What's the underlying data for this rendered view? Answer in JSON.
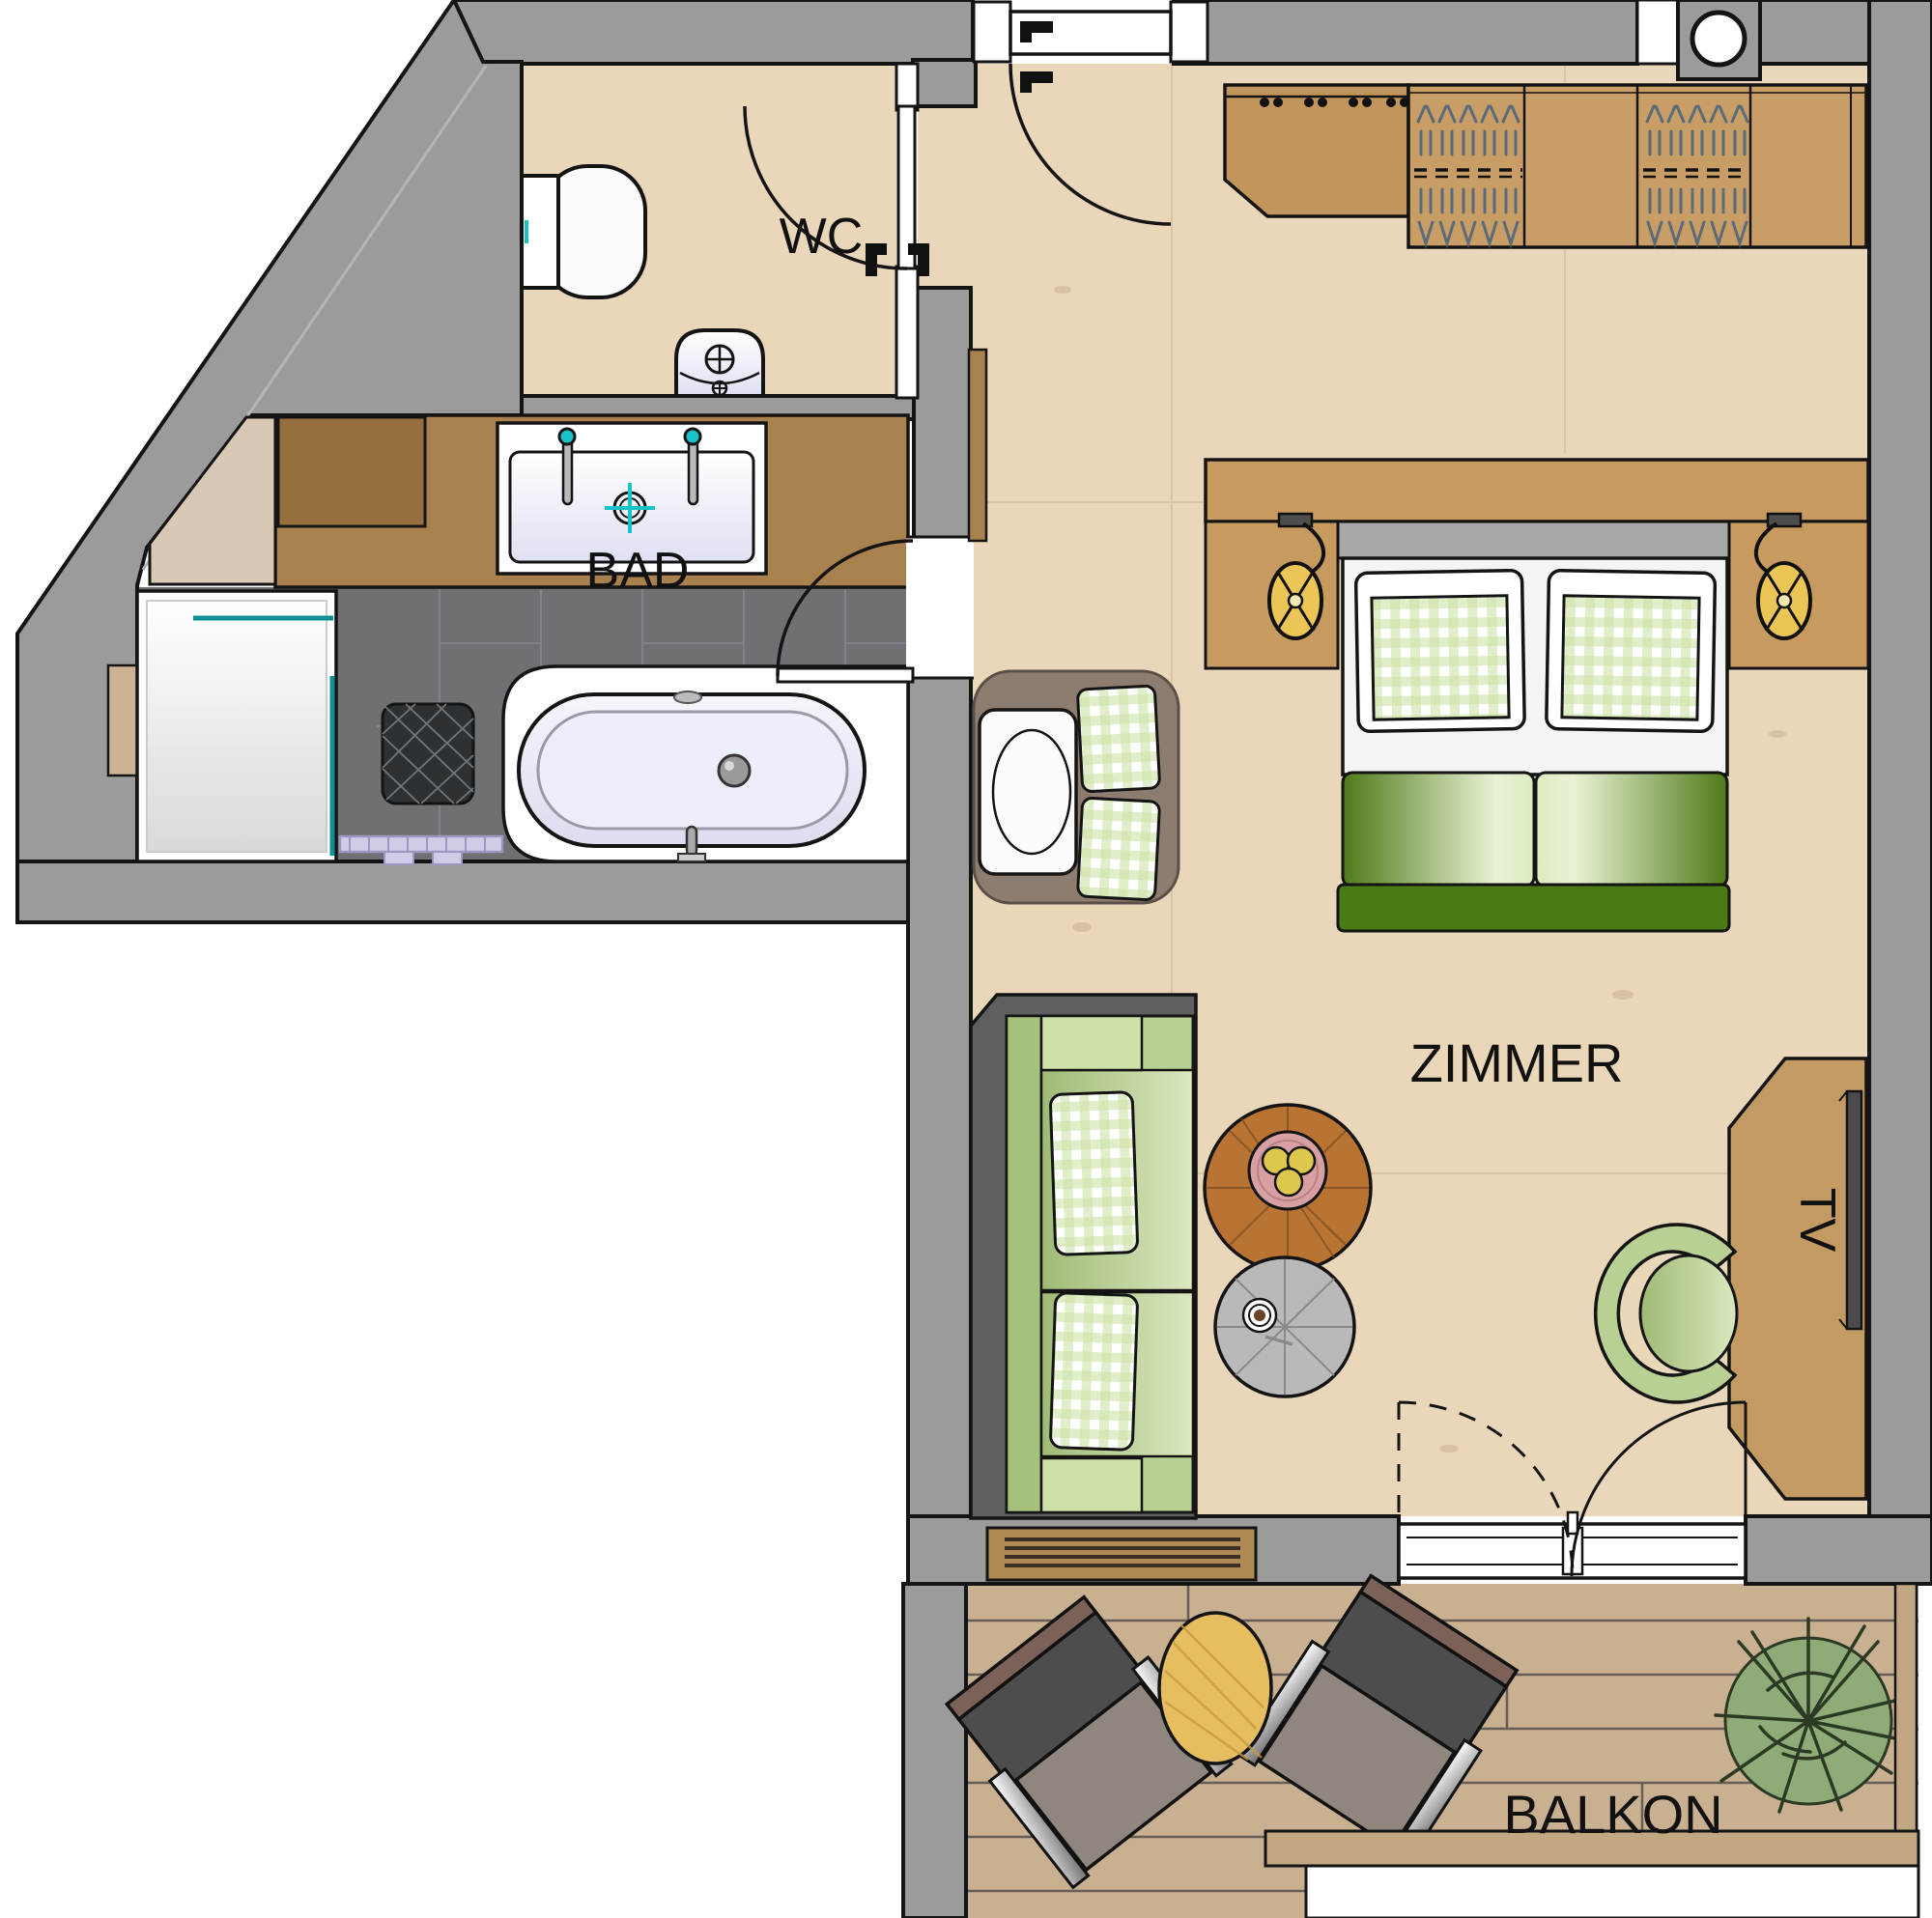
{
  "title": "Hotel suite floor plan",
  "labels": {
    "wc": "WC",
    "bathroom": "BAD",
    "room": "ZIMMER",
    "tv": "TV",
    "balcony": "BALKON"
  },
  "rooms": [
    {
      "id": "wc",
      "label": "WC",
      "floor": "light wood"
    },
    {
      "id": "bathroom",
      "label": "BAD",
      "floor": "dark gray tile"
    },
    {
      "id": "room",
      "label": "ZIMMER",
      "floor": "light wood"
    },
    {
      "id": "balcony",
      "label": "BALKON",
      "floor": "wood decking"
    },
    {
      "id": "entry",
      "label": "",
      "floor": "light wood"
    }
  ],
  "fixtures": [
    "toilet",
    "wc-hand-basin",
    "double-vanity-sink",
    "shower",
    "shower-drain",
    "bath-mat",
    "freestanding-bathtub",
    "stone-shelf",
    "entry-door",
    "wc-door",
    "bathroom-door",
    "coat-rack",
    "wardrobe-with-hangers",
    "service-shaft",
    "double-bed",
    "wall-lamp-left",
    "wall-lamp-right",
    "reading-armchair",
    "area-rug",
    "sofa",
    "floor-grille",
    "wood-side-table",
    "fruit-plate",
    "gray-side-table",
    "coffee-cup",
    "tv-sideboard",
    "tv-screen",
    "swivel-armchair",
    "balcony-double-door",
    "lounge-chair-1",
    "lounge-chair-2",
    "balcony-table",
    "potted-plant",
    "balcony-railing"
  ],
  "palette": {
    "wall_gray": "#9b9b9b",
    "outline": "#141414",
    "floor_wood": "#ead6b8",
    "bath_tile": "#6e7073",
    "counter_wood": "#a8814e",
    "furniture_wood": "#c79a5f",
    "deck_wood": "#c9b091",
    "sofa_green": "#b9d094",
    "duvet_green": "#4f7a18",
    "check_green": "#cde3a6",
    "glass_teal": "#0e8f93",
    "lamp_yellow": "#ecc557",
    "plate_pink": "#d9a0a4",
    "apple_yellow": "#ddc84d",
    "rug_brown": "#8d7d71",
    "stone_beige": "#d8c8b4"
  }
}
